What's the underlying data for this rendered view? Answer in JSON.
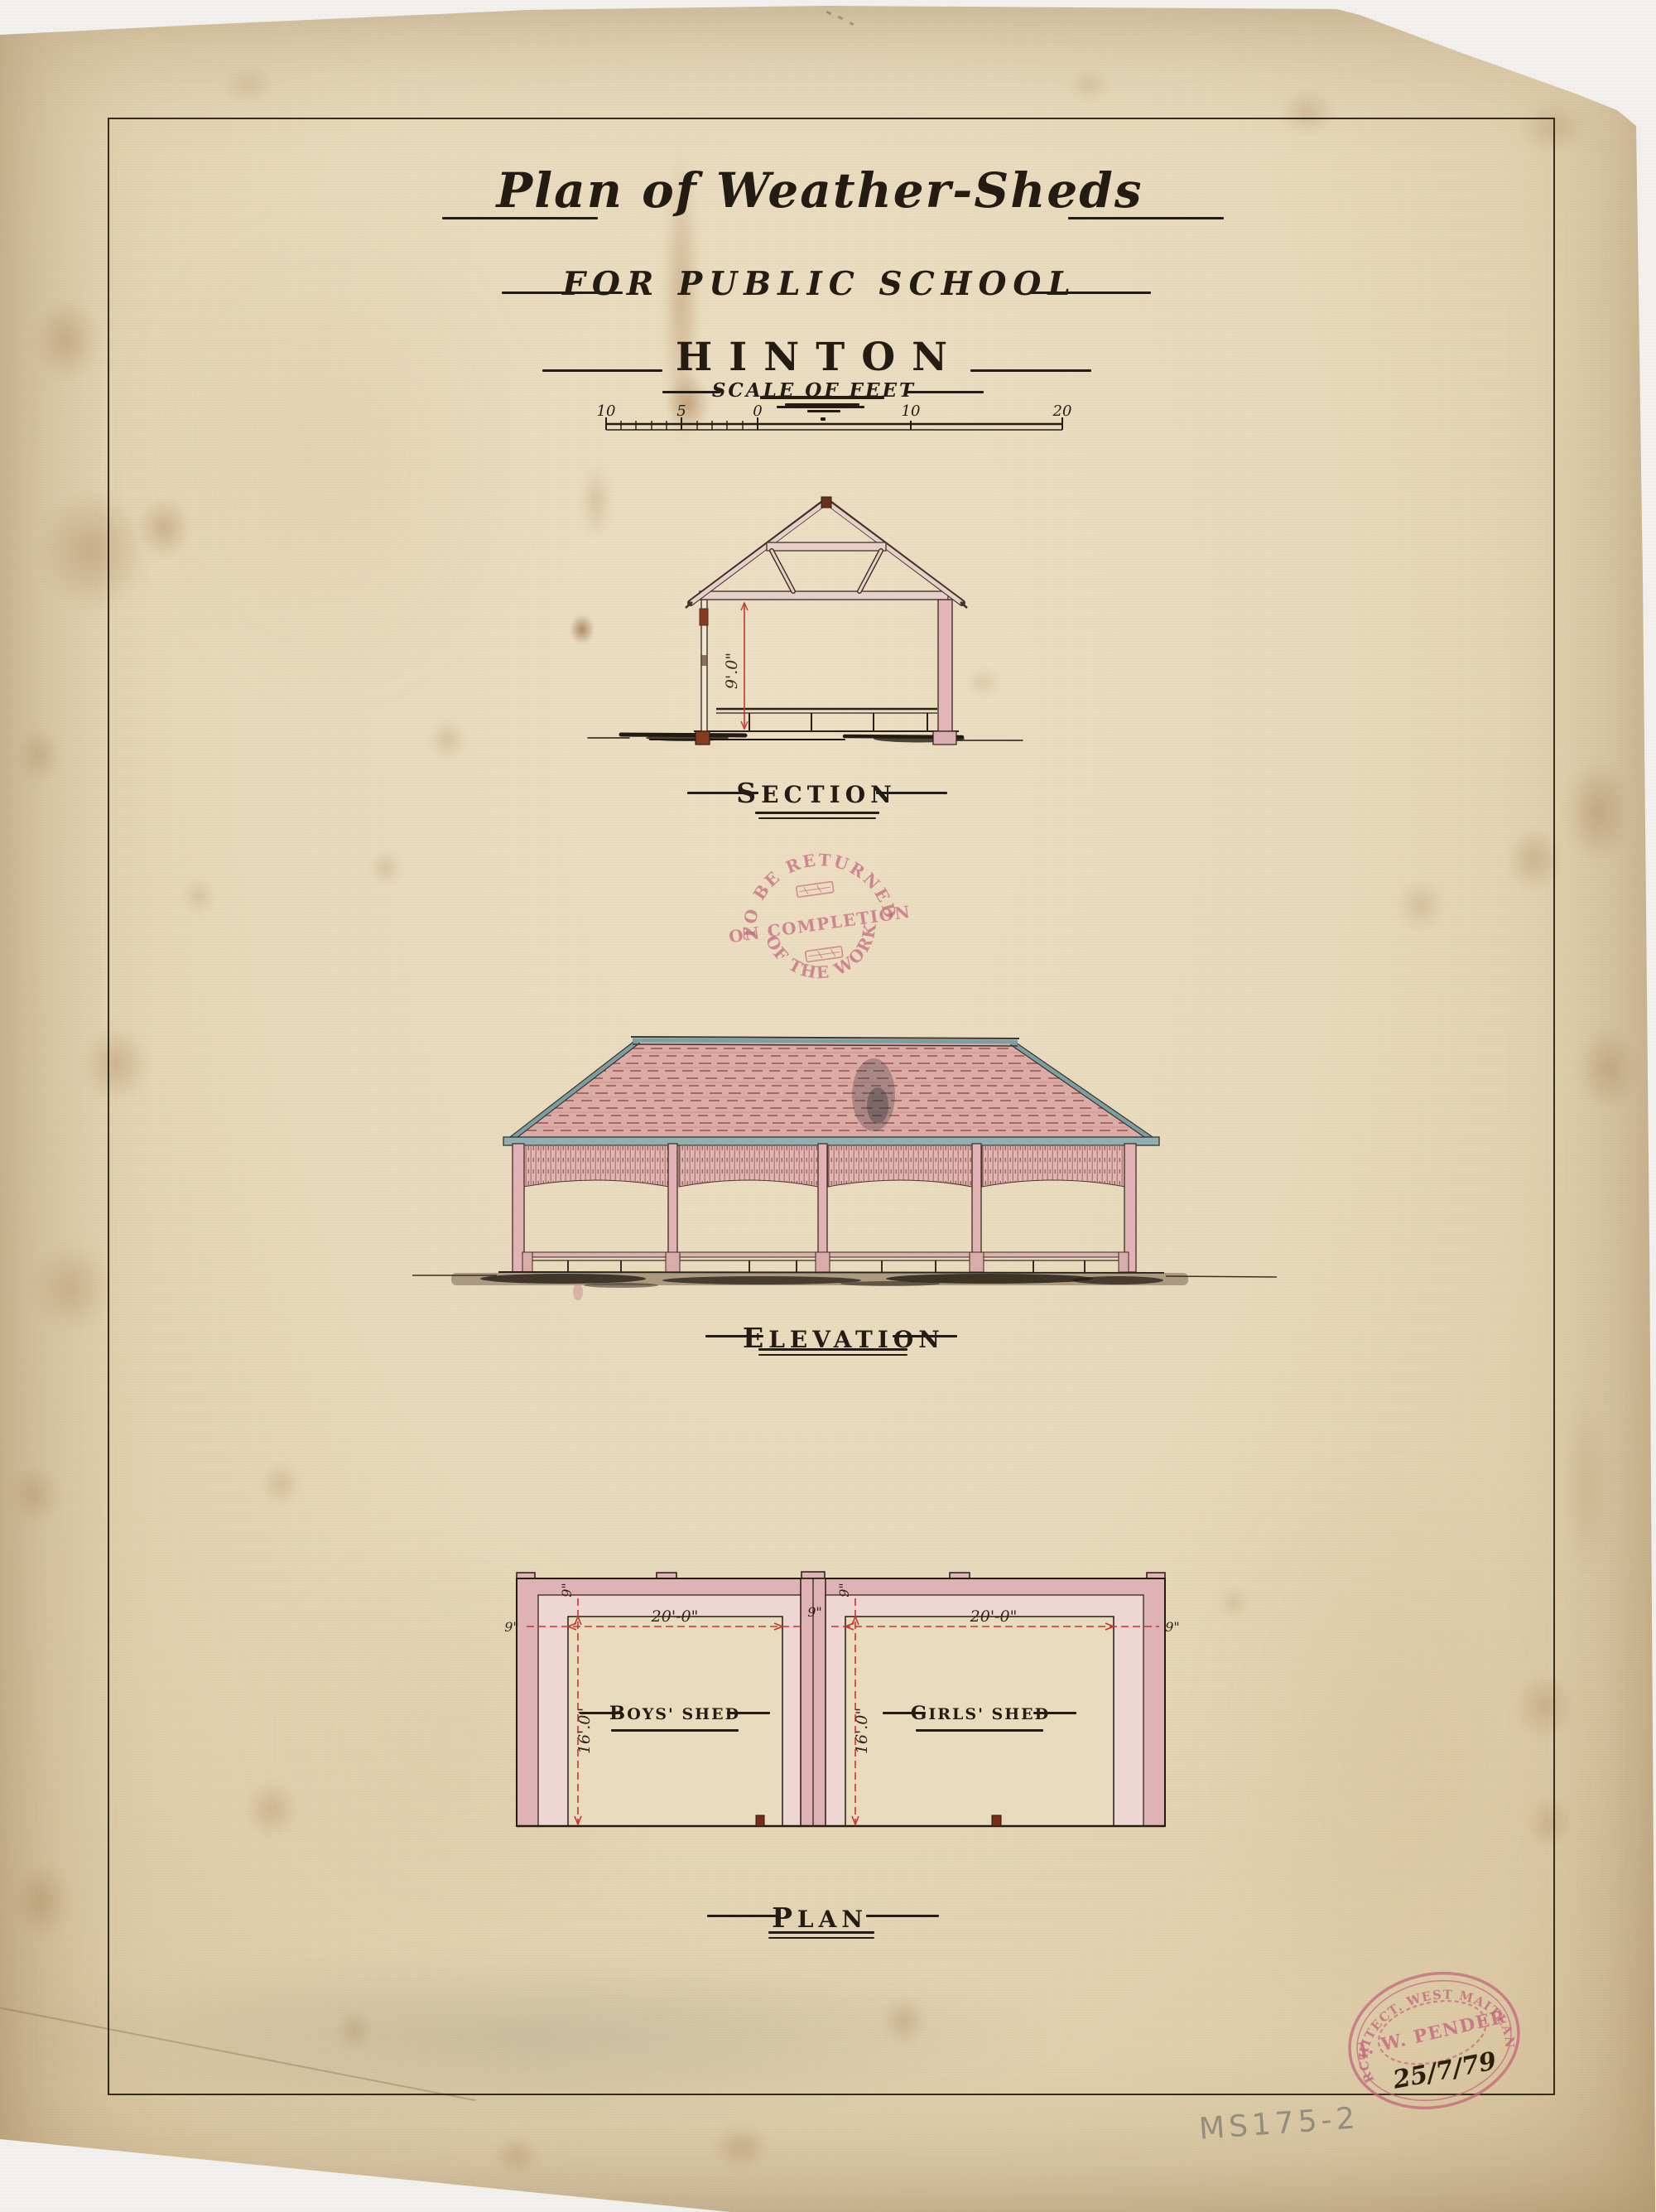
{
  "sheet": {
    "catalog_number": "MS175-2"
  },
  "title": {
    "line1": "Plan of Weather-Sheds",
    "line2": "For Public School",
    "line3": "HINTON"
  },
  "scale_bar": {
    "label": "Scale of Feet",
    "ticks": [
      "10",
      "5",
      "0",
      "10",
      "20"
    ]
  },
  "section": {
    "label": "SECTION",
    "height_dim": "9'.0\""
  },
  "elevation": {
    "label": "ELEVATION"
  },
  "plan": {
    "label": "PLAN",
    "wall_thickness": "9\"",
    "rooms": [
      {
        "name": "BOYS' SHED",
        "width": "20'-0\"",
        "depth": "16'.0\""
      },
      {
        "name": "GIRLS' SHED",
        "width": "20'-0\"",
        "depth": "16'.0\""
      }
    ]
  },
  "stamps": {
    "return_stamp": {
      "arc_top": "TO BE RETURNED",
      "middle": "ON COMPLETION",
      "arc_bottom": "OF THE WORK"
    },
    "architect_stamp": {
      "arc": "ARCHITECT. WEST MAITLAND",
      "name": "J. W. PENDER",
      "date": "25/7/79"
    }
  },
  "colors": {
    "paper": "#e8dabc",
    "ink": "#241c12",
    "wash_pink": "#dfb2b6",
    "wash_pink_light": "#eed7d2",
    "roof_pink": "#dcaba6",
    "trim_teal": "#7ba0a4",
    "dimension_red": "#c5372c",
    "stamp_pink": "#c4657c",
    "footing_red": "#7c2b15",
    "pencil_grey": "#8b867c"
  }
}
